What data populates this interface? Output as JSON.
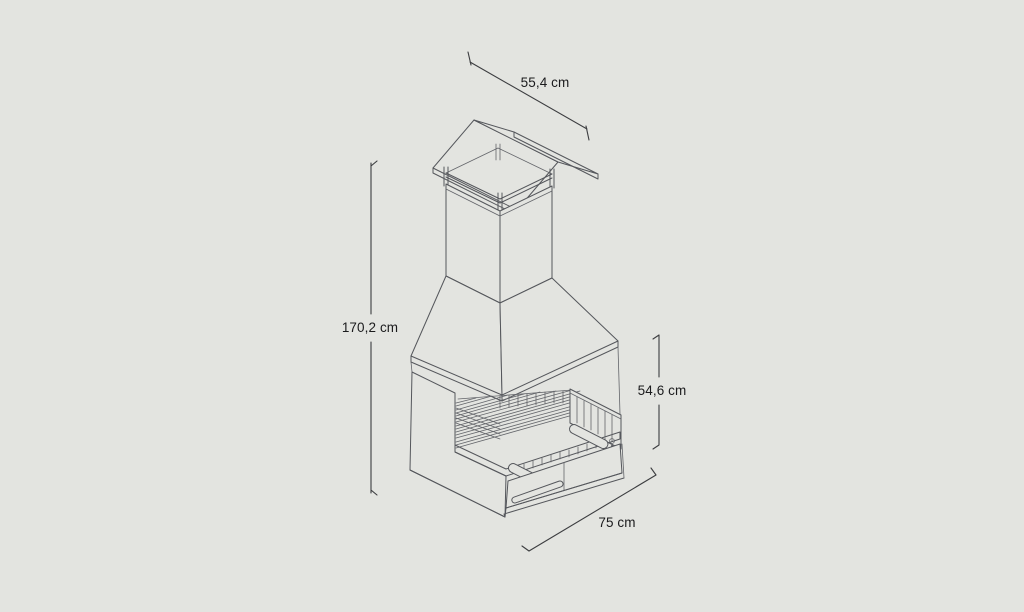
{
  "page": {
    "background": "#e3e4e0"
  },
  "drawing": {
    "line_color": "#55575c",
    "text_color": "#1b1b1d"
  },
  "dimensions": {
    "cap_width_top": {
      "label": "55,4 cm"
    },
    "total_height_left": {
      "label": "170,2 cm"
    },
    "opening_height_right": {
      "label": "54,6 cm"
    },
    "base_width_bottom": {
      "label": "75 cm"
    }
  }
}
